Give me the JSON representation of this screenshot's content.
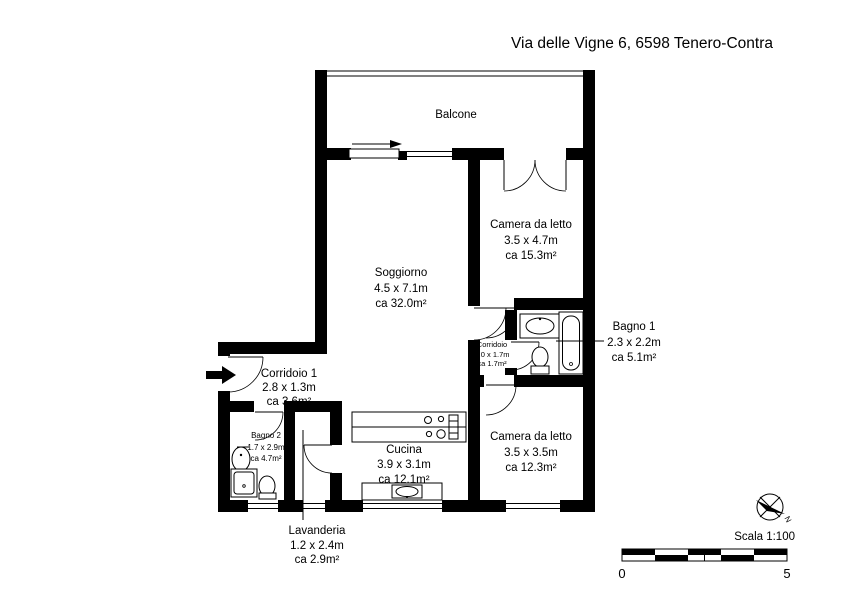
{
  "title": "Via delle Vigne 6, 6598 Tenero-Contra",
  "plan": {
    "balcone": {
      "name": "Balcone"
    },
    "soggiorno": {
      "name": "Soggiorno",
      "dims": "4.5 x 7.1m",
      "area": "ca 32.0m²"
    },
    "camera1": {
      "name": "Camera da letto",
      "dims": "3.5 x 4.7m",
      "area": "ca 15.3m²"
    },
    "bagno1": {
      "name": "Bagno 1",
      "dims": "2.3 x 2.2m",
      "area": "ca 5.1m²"
    },
    "corridoio": {
      "name": "Corridoio",
      "dims": "1.0 x 1.7m",
      "area": "ca 1.7m²"
    },
    "corridoio1": {
      "name": "Corridoio 1",
      "dims": "2.8 x 1.3m",
      "area": "ca 3.6m²"
    },
    "bagno2": {
      "name": "Bagno 2",
      "dims": "1.7 x 2.9m",
      "area": "ca 4.7m²"
    },
    "cucina": {
      "name": "Cucina",
      "dims": "3.9 x 3.1m",
      "area": "ca 12.1m²"
    },
    "camera2": {
      "name": "Camera da letto",
      "dims": "3.5 x 3.5m",
      "area": "ca 12.3m²"
    },
    "lavanderia": {
      "name": "Lavanderia",
      "dims": "1.2 x 2.4m",
      "area": "ca 2.9m²"
    }
  },
  "footer": {
    "scale_label": "Scala 1:100",
    "scale_start": "0",
    "scale_end": "5",
    "north": "N"
  },
  "colors": {
    "ink": "#000000",
    "paper": "#ffffff"
  }
}
